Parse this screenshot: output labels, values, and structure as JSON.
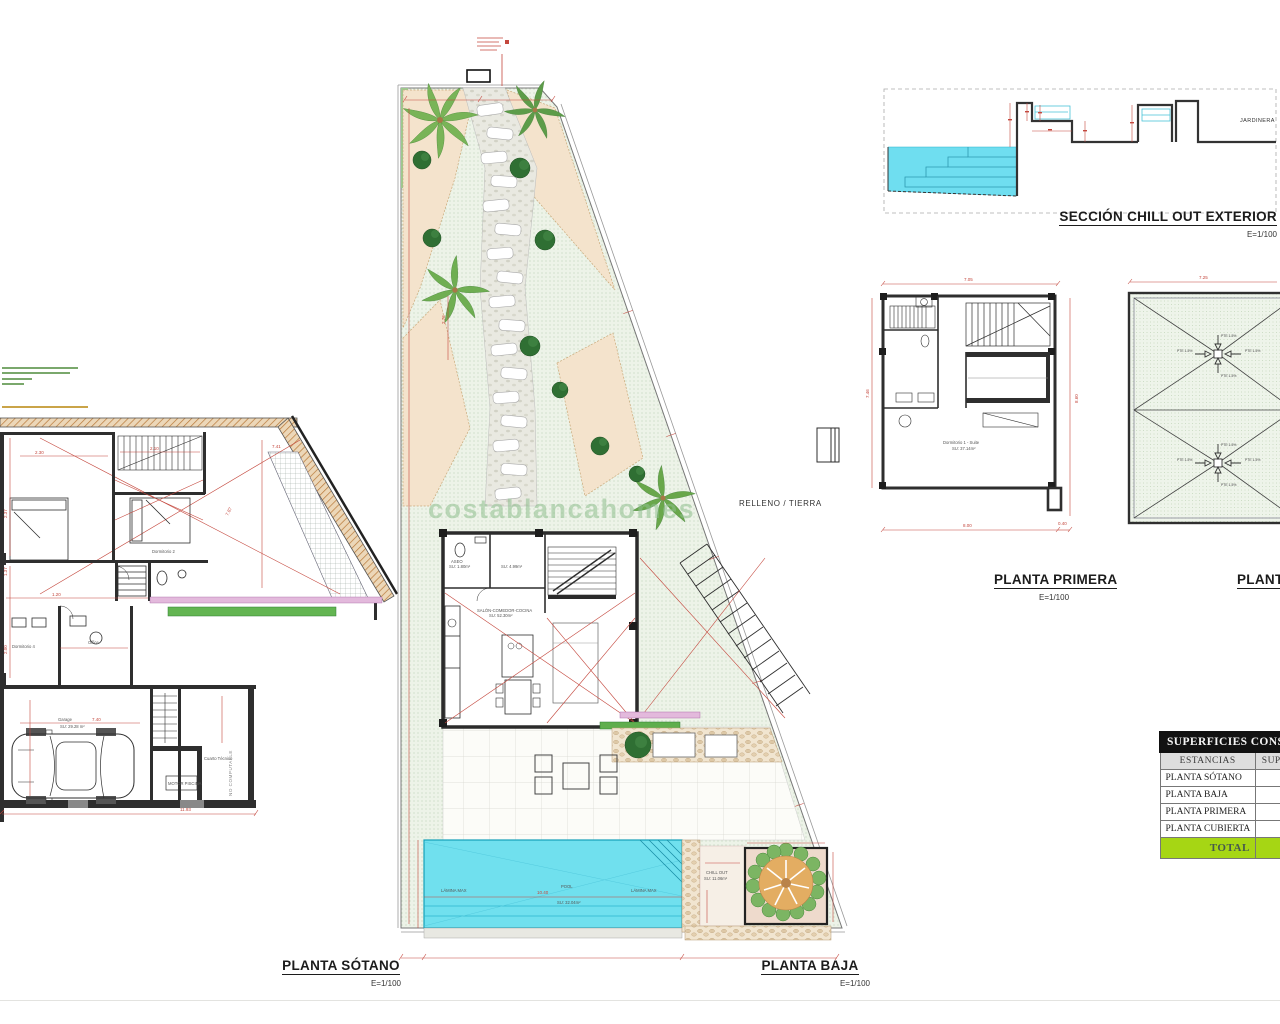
{
  "sheet": {
    "watermark": "costablancahomes"
  },
  "sotano": {
    "title": "PLANTA SÓTANO",
    "scale": "E=1/100",
    "labels": {
      "garage": "Garage",
      "garage_area": "SU: 29.28 m²",
      "cuarto_tecnico": "Cuarto Técnico",
      "motor_piscina": "MOTOR PISCINA",
      "no_computable": "NO COMPUTABLE",
      "dorm2": "Dormitorio 2",
      "dorm4": "Dormitorio 4",
      "office": "Office"
    },
    "dims": {
      "garage_width": "7.40",
      "d1": "2.30",
      "d2": "2.37",
      "d3": "2.10",
      "d4": "7.87",
      "d5": "7.41",
      "d6": "1.37",
      "d7": "2.00",
      "d8": "1.20",
      "d9": "11.93"
    }
  },
  "baja": {
    "title": "PLANTA BAJA",
    "scale": "E=1/100",
    "labels": {
      "relleno": "RELLENO / TIERRA",
      "pool": "POOL",
      "pool_area": "SU: 32.04m²",
      "lamina_max": "LÁMINA MAX",
      "chill_out": "CHILL OUT",
      "chill_out_area": "SU: 11.06m²",
      "salon": "SALÓN-COMEDOR-COCINA",
      "salon_area": "SU: 52.30m²",
      "aseo": "ASEO",
      "aseo_area": "SU: 1.80m²",
      "hall_area": "SU: 4.99m²"
    },
    "dims": {
      "d1": "2.76",
      "pool_length": "10.40"
    }
  },
  "primera": {
    "title": "PLANTA PRIMERA",
    "scale": "E=1/100",
    "labels": {
      "room": "Dormitorio 1 - Suite",
      "room_area": "SU: 37.14m²"
    },
    "dims": {
      "top": "7.05",
      "left": "7.46",
      "right": "8.60",
      "bottom": "8.00",
      "offset": "0.40",
      "i1": "4.43",
      "i2": "3.41",
      "i3": "2.06"
    }
  },
  "cubierta": {
    "title": "PLANTA C",
    "slope": "PTE 1-5%",
    "dims": {
      "top": "7.25",
      "bottom": "8.00"
    }
  },
  "seccion": {
    "title": "SECCIÓN CHILL OUT EXTERIOR",
    "scale": "E=1/100",
    "jardinera": "JARDINERA"
  },
  "table": {
    "title": "SUPERFICIES CONSTRU",
    "col_estancias": "ESTANCIAS",
    "col_superficie": "SUP. CON",
    "rows": [
      {
        "label": "PLANTA SÓTANO",
        "value": "164"
      },
      {
        "label": "PLANTA BAJA",
        "value": "57"
      },
      {
        "label": "PLANTA PRIMERA",
        "value": "57"
      },
      {
        "label": "PLANTA CUBIERTA",
        "value": ""
      }
    ],
    "total_label": "TOTAL",
    "total_value": ""
  },
  "colors": {
    "pool": "#6FDEF0",
    "grass": "#EDF3E8",
    "dim_red": "#C4473D",
    "wall": "#2E2E2E",
    "hatch_orange": "#C08040",
    "tree_green": "#7CB563",
    "total_row_green": "#A6D614"
  }
}
